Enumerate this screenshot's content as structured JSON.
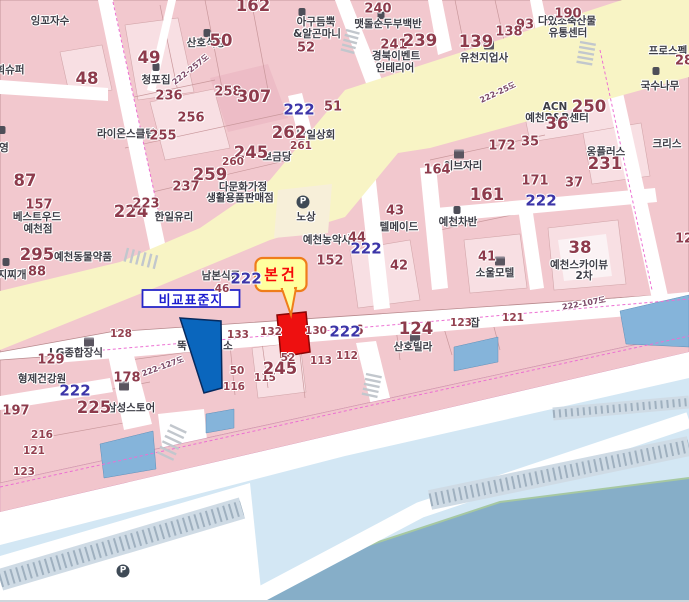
{
  "map": {
    "markers": {
      "subject": {
        "label": "본건"
      },
      "comparison": {
        "label": "비교표준지"
      }
    },
    "colors": {
      "subject_parcel": "#ee1010",
      "subject_bubble_fill": "#ffff9e",
      "subject_bubble_border": "#ef7d1a",
      "comparison_parcel": "#0a66bd",
      "comparison_box_border": "#2626c8",
      "block_pink": "#f2c8ce",
      "road_yellow": "#f8f4c5",
      "river_light": "#d3e7f4",
      "river_dark": "#86aec8",
      "boundary_magenta": "#ec6fd2",
      "parcel_number": "#8d3b4c",
      "road_number_blue": "#3c35a8"
    },
    "labels": [
      {
        "t": "잉꼬자수",
        "x": 50,
        "y": 21,
        "c": "name"
      },
      {
        "t": "희슈퍼",
        "x": 10,
        "y": 70,
        "c": "name"
      },
      {
        "t": "산호식당",
        "x": 206,
        "y": 43,
        "c": "name"
      },
      {
        "t": "아구듬뿍",
        "x": 316,
        "y": 22,
        "c": "name"
      },
      {
        "t": "&알곤마니",
        "x": 317,
        "y": 34,
        "c": "name"
      },
      {
        "t": "청포집",
        "x": 156,
        "y": 80,
        "c": "name"
      },
      {
        "t": "맷돌순두부백반",
        "x": 388,
        "y": 24,
        "c": "name"
      },
      {
        "t": "경북이벤트",
        "x": 396,
        "y": 56,
        "c": "name"
      },
      {
        "t": "인테리어",
        "x": 395,
        "y": 68,
        "c": "name"
      },
      {
        "t": "다있소축산물",
        "x": 567,
        "y": 21,
        "c": "name"
      },
      {
        "t": "유통센터",
        "x": 568,
        "y": 33,
        "c": "name"
      },
      {
        "t": "유천지업사",
        "x": 484,
        "y": 58,
        "c": "name"
      },
      {
        "t": "라이온스클럽",
        "x": 126,
        "y": 134,
        "c": "name"
      },
      {
        "t": "남일상회",
        "x": 316,
        "y": 135,
        "c": "name"
      },
      {
        "t": "보금당",
        "x": 277,
        "y": 157,
        "c": "name"
      },
      {
        "t": "다문화가정",
        "x": 243,
        "y": 187,
        "c": "name"
      },
      {
        "t": "생활용품판매점",
        "x": 240,
        "y": 198,
        "c": "name"
      },
      {
        "t": "한일유리",
        "x": 174,
        "y": 217,
        "c": "name"
      },
      {
        "t": "노상",
        "x": 306,
        "y": 217,
        "c": "name"
      },
      {
        "t": "예천농악사",
        "x": 327,
        "y": 240,
        "c": "name"
      },
      {
        "t": "텔메이드",
        "x": 399,
        "y": 227,
        "c": "name"
      },
      {
        "t": "예천차반",
        "x": 458,
        "y": 222,
        "c": "name"
      },
      {
        "t": "국수나무",
        "x": 660,
        "y": 86,
        "c": "name"
      },
      {
        "t": "프로스펙",
        "x": 668,
        "y": 51,
        "c": "name"
      },
      {
        "t": "크리스",
        "x": 667,
        "y": 144,
        "c": "name"
      },
      {
        "t": "이브자리",
        "x": 463,
        "y": 166,
        "c": "name"
      },
      {
        "t": "옹플러스",
        "x": 606,
        "y": 152,
        "c": "name"
      },
      {
        "t": "ACN",
        "x": 555,
        "y": 107,
        "c": "name"
      },
      {
        "t": "예천P&B센터",
        "x": 557,
        "y": 118,
        "c": "name"
      },
      {
        "t": "남본식품",
        "x": 221,
        "y": 276,
        "c": "name"
      },
      {
        "t": "베스트우드",
        "x": 37,
        "y": 217,
        "c": "name"
      },
      {
        "t": "예천점",
        "x": 38,
        "y": 229,
        "c": "name"
      },
      {
        "t": "예천동물약품",
        "x": 83,
        "y": 257,
        "c": "name"
      },
      {
        "t": "지찌개",
        "x": 12,
        "y": 275,
        "c": "name"
      },
      {
        "t": "영",
        "x": 4,
        "y": 148,
        "c": "name"
      },
      {
        "t": "형제건강원",
        "x": 42,
        "y": 379,
        "c": "name"
      },
      {
        "t": "LG종합장식",
        "x": 76,
        "y": 353,
        "c": "name"
      },
      {
        "t": "삼성스토어",
        "x": 131,
        "y": 408,
        "c": "name"
      },
      {
        "t": "뚝",
        "x": 182,
        "y": 346,
        "c": "name"
      },
      {
        "t": "소",
        "x": 228,
        "y": 346,
        "c": "name"
      },
      {
        "t": "소울모텔",
        "x": 495,
        "y": 273,
        "c": "name"
      },
      {
        "t": "예천스카이뷰",
        "x": 579,
        "y": 265,
        "c": "name"
      },
      {
        "t": "2차",
        "x": 584,
        "y": 276,
        "c": "name"
      },
      {
        "t": "산호빌라",
        "x": 413,
        "y": 347,
        "c": "name"
      },
      {
        "t": "잡",
        "x": 475,
        "y": 323,
        "c": "name"
      },
      {
        "t": "162",
        "x": 253,
        "y": 6,
        "c": "numL"
      },
      {
        "t": "52",
        "x": 306,
        "y": 48,
        "c": "numM"
      },
      {
        "t": "50",
        "x": 221,
        "y": 41,
        "c": "numL"
      },
      {
        "t": "49",
        "x": 149,
        "y": 58,
        "c": "numL"
      },
      {
        "t": "48",
        "x": 87,
        "y": 79,
        "c": "numL"
      },
      {
        "t": "87",
        "x": 25,
        "y": 181,
        "c": "numL"
      },
      {
        "t": "240",
        "x": 378,
        "y": 9,
        "c": "numM"
      },
      {
        "t": "241",
        "x": 394,
        "y": 45,
        "c": "numM"
      },
      {
        "t": "239",
        "x": 420,
        "y": 41,
        "c": "numL"
      },
      {
        "t": "190",
        "x": 568,
        "y": 14,
        "c": "numM"
      },
      {
        "t": "93",
        "x": 525,
        "y": 25,
        "c": "numM"
      },
      {
        "t": "138",
        "x": 509,
        "y": 32,
        "c": "numM"
      },
      {
        "t": "139",
        "x": 476,
        "y": 42,
        "c": "numL"
      },
      {
        "t": "236",
        "x": 169,
        "y": 96,
        "c": "numM"
      },
      {
        "t": "258",
        "x": 228,
        "y": 92,
        "c": "numM"
      },
      {
        "t": "307",
        "x": 254,
        "y": 97,
        "c": "numL"
      },
      {
        "t": "51",
        "x": 333,
        "y": 107,
        "c": "numM"
      },
      {
        "t": "256",
        "x": 191,
        "y": 118,
        "c": "numM"
      },
      {
        "t": "255",
        "x": 163,
        "y": 136,
        "c": "numM"
      },
      {
        "t": "262",
        "x": 289,
        "y": 133,
        "c": "numL"
      },
      {
        "t": "261",
        "x": 301,
        "y": 146,
        "c": "num"
      },
      {
        "t": "245",
        "x": 251,
        "y": 153,
        "c": "numL"
      },
      {
        "t": "260",
        "x": 233,
        "y": 162,
        "c": "num"
      },
      {
        "t": "259",
        "x": 210,
        "y": 175,
        "c": "numL"
      },
      {
        "t": "237",
        "x": 186,
        "y": 187,
        "c": "numM"
      },
      {
        "t": "224",
        "x": 131,
        "y": 212,
        "c": "numL"
      },
      {
        "t": "223",
        "x": 146,
        "y": 204,
        "c": "numM"
      },
      {
        "t": "295",
        "x": 37,
        "y": 255,
        "c": "numL"
      },
      {
        "t": "88",
        "x": 37,
        "y": 272,
        "c": "numM"
      },
      {
        "t": "157",
        "x": 39,
        "y": 205,
        "c": "numM"
      },
      {
        "t": "172",
        "x": 502,
        "y": 146,
        "c": "numM"
      },
      {
        "t": "35",
        "x": 530,
        "y": 142,
        "c": "numM"
      },
      {
        "t": "164",
        "x": 437,
        "y": 170,
        "c": "numM"
      },
      {
        "t": "171",
        "x": 535,
        "y": 181,
        "c": "numM"
      },
      {
        "t": "37",
        "x": 574,
        "y": 183,
        "c": "numM"
      },
      {
        "t": "161",
        "x": 487,
        "y": 195,
        "c": "numL"
      },
      {
        "t": "250",
        "x": 589,
        "y": 107,
        "c": "numL"
      },
      {
        "t": "36",
        "x": 557,
        "y": 124,
        "c": "numL"
      },
      {
        "t": "28",
        "x": 684,
        "y": 61,
        "c": "numM"
      },
      {
        "t": "231",
        "x": 605,
        "y": 164,
        "c": "numL"
      },
      {
        "t": "152",
        "x": 330,
        "y": 261,
        "c": "numM"
      },
      {
        "t": "44",
        "x": 357,
        "y": 238,
        "c": "numM"
      },
      {
        "t": "42",
        "x": 399,
        "y": 266,
        "c": "numM"
      },
      {
        "t": "43",
        "x": 395,
        "y": 211,
        "c": "numM"
      },
      {
        "t": "41",
        "x": 487,
        "y": 257,
        "c": "numM"
      },
      {
        "t": "38",
        "x": 580,
        "y": 248,
        "c": "numL"
      },
      {
        "t": "12",
        "x": 684,
        "y": 239,
        "c": "numM"
      },
      {
        "t": "121",
        "x": 513,
        "y": 318,
        "c": "num"
      },
      {
        "t": "123",
        "x": 461,
        "y": 323,
        "c": "num"
      },
      {
        "t": "124",
        "x": 416,
        "y": 329,
        "c": "numL"
      },
      {
        "t": "133",
        "x": 238,
        "y": 335,
        "c": "num"
      },
      {
        "t": "132",
        "x": 271,
        "y": 332,
        "c": "num"
      },
      {
        "t": "130",
        "x": 316,
        "y": 331,
        "c": "num"
      },
      {
        "t": "6",
        "x": 359,
        "y": 331,
        "c": "numM"
      },
      {
        "t": "50",
        "x": 237,
        "y": 371,
        "c": "num"
      },
      {
        "t": "116",
        "x": 234,
        "y": 387,
        "c": "num"
      },
      {
        "t": "115",
        "x": 265,
        "y": 378,
        "c": "num"
      },
      {
        "t": "245",
        "x": 280,
        "y": 369,
        "c": "numL"
      },
      {
        "t": "113",
        "x": 321,
        "y": 361,
        "c": "num"
      },
      {
        "t": "112",
        "x": 347,
        "y": 356,
        "c": "num"
      },
      {
        "t": "52",
        "x": 288,
        "y": 358,
        "c": "num"
      },
      {
        "t": "128",
        "x": 121,
        "y": 334,
        "c": "num"
      },
      {
        "t": "178",
        "x": 127,
        "y": 378,
        "c": "numM"
      },
      {
        "t": "129",
        "x": 51,
        "y": 360,
        "c": "numM"
      },
      {
        "t": "225",
        "x": 94,
        "y": 408,
        "c": "numL"
      },
      {
        "t": "197",
        "x": 16,
        "y": 411,
        "c": "numM"
      },
      {
        "t": "216",
        "x": 42,
        "y": 435,
        "c": "num"
      },
      {
        "t": "121",
        "x": 34,
        "y": 451,
        "c": "num"
      },
      {
        "t": "123",
        "x": 24,
        "y": 472,
        "c": "num"
      },
      {
        "t": "46",
        "x": 222,
        "y": 289,
        "c": "num"
      },
      {
        "t": "222",
        "x": 299,
        "y": 110,
        "c": "blue"
      },
      {
        "t": "222",
        "x": 366,
        "y": 249,
        "c": "blue"
      },
      {
        "t": "222",
        "x": 246,
        "y": 279,
        "c": "blue"
      },
      {
        "t": "222",
        "x": 345,
        "y": 332,
        "c": "blue"
      },
      {
        "t": "222",
        "x": 541,
        "y": 201,
        "c": "blue"
      },
      {
        "t": "222",
        "x": 75,
        "y": 391,
        "c": "blue"
      },
      {
        "t": "222-257도",
        "x": 191,
        "y": 70,
        "c": "road",
        "r": -38
      },
      {
        "t": "222-25도",
        "x": 498,
        "y": 93,
        "c": "road",
        "r": -25
      },
      {
        "t": "222-127도",
        "x": 163,
        "y": 367,
        "c": "road",
        "r": -20
      },
      {
        "t": "222-107도",
        "x": 584,
        "y": 304,
        "c": "road",
        "r": -10
      }
    ],
    "icons": [
      {
        "k": "restaurant",
        "x": 207,
        "y": 33
      },
      {
        "k": "restaurant",
        "x": 302,
        "y": 12
      },
      {
        "k": "restaurant",
        "x": 381,
        "y": 15
      },
      {
        "k": "restaurant",
        "x": 156,
        "y": 67
      },
      {
        "k": "restaurant",
        "x": 457,
        "y": 210
      },
      {
        "k": "restaurant",
        "x": 656,
        "y": 71
      },
      {
        "k": "restaurant",
        "x": 6,
        "y": 262
      },
      {
        "k": "restaurant",
        "x": 2,
        "y": 130
      },
      {
        "k": "building",
        "x": 489,
        "y": 45
      },
      {
        "k": "building",
        "x": 459,
        "y": 154
      },
      {
        "k": "building",
        "x": 500,
        "y": 261
      },
      {
        "k": "building",
        "x": 415,
        "y": 338
      },
      {
        "k": "building",
        "x": 89,
        "y": 342
      },
      {
        "k": "building",
        "x": 124,
        "y": 386
      },
      {
        "k": "parking",
        "x": 303,
        "y": 202,
        "g": "P"
      },
      {
        "k": "parking",
        "x": 123,
        "y": 571,
        "g": "P"
      }
    ]
  }
}
